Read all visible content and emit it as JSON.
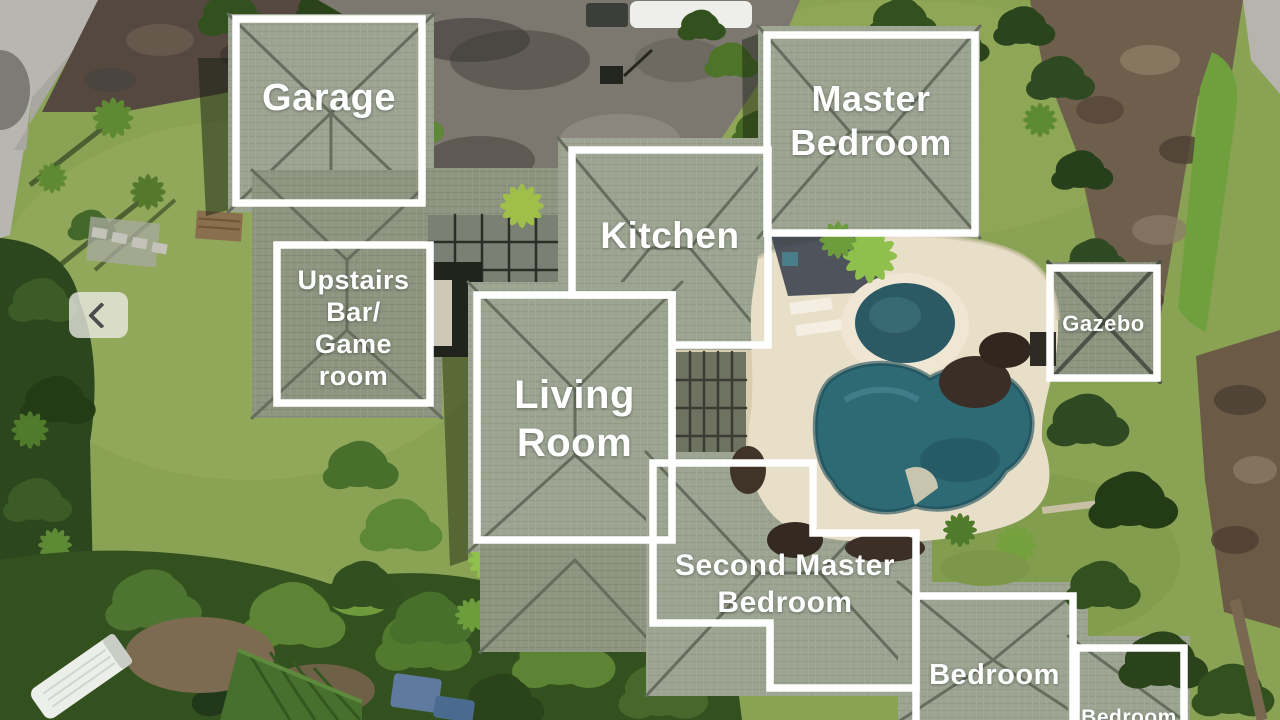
{
  "annotations": {
    "garage": {
      "label": "Garage"
    },
    "master_bedroom": {
      "lines": [
        "Master",
        "Bedroom"
      ]
    },
    "kitchen": {
      "label": "Kitchen"
    },
    "upstairs_bar_game_room": {
      "lines": [
        "Upstairs",
        "Bar/",
        "Game",
        "room"
      ]
    },
    "living_room": {
      "lines": [
        "Living",
        "Room"
      ]
    },
    "gazebo": {
      "label": "Gazebo"
    },
    "second_master_bedroom": {
      "lines": [
        "Second Master",
        "Bedroom"
      ]
    },
    "bedroom": {
      "label": "Bedroom"
    },
    "bedroom_partial": {
      "label": "Bedroom"
    }
  },
  "carousel": {
    "prev_icon": "chevron-left"
  },
  "colors": {
    "annotation_border": "#ffffff",
    "annotation_text": "#ffffff",
    "lawn": "#8aa254",
    "roof": "#9da492",
    "pool_water": "#2e6a74",
    "deck": "#e8dfc9",
    "driveway": "#7c776f",
    "road": "#b7b6b0"
  }
}
